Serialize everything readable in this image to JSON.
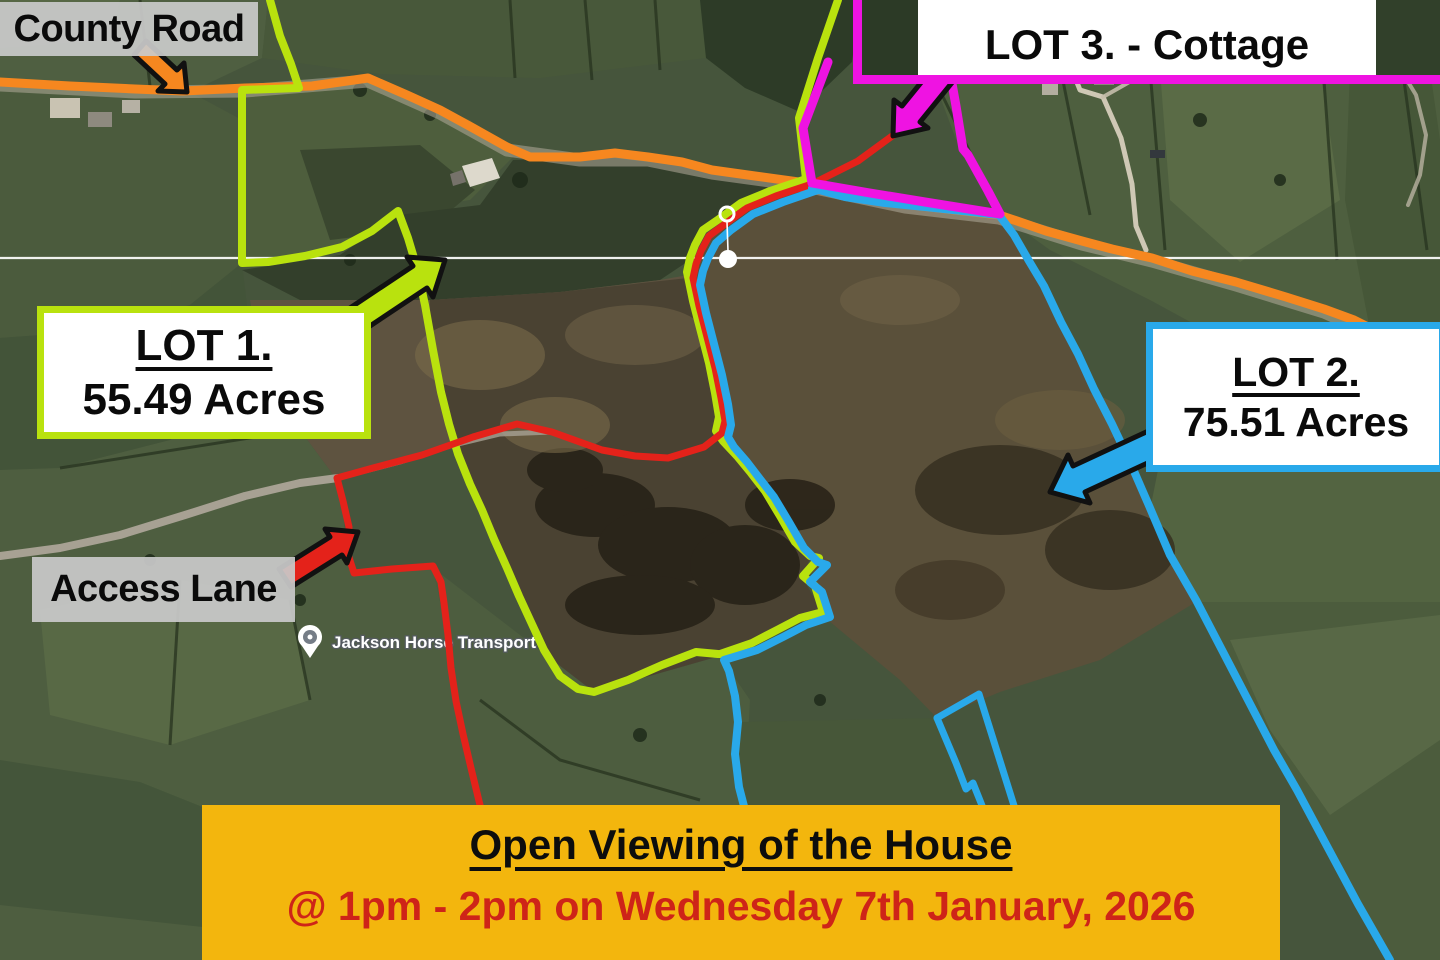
{
  "labels": {
    "county_road": "County Road",
    "access_lane": "Access Lane"
  },
  "lots": {
    "lot1": {
      "title": "LOT 1.",
      "area": "55.49 Acres"
    },
    "lot2": {
      "title": "LOT 2.",
      "area": "75.51 Acres"
    },
    "lot3": {
      "title": "LOT 3. - Cottage"
    }
  },
  "poi": {
    "name": "Jackson Horse Transport"
  },
  "banner": {
    "heading": "Open Viewing of the House",
    "detail": "@ 1pm - 2pm on Wednesday 7th January, 2026"
  },
  "colors": {
    "lot1_green": "#b9e20e",
    "lot2_blue": "#29a9ea",
    "lot3_magenta": "#ef13e2",
    "access_red": "#e4221a",
    "road_orange": "#f6871f",
    "banner_bg": "#f3b60d",
    "banner_detail_red": "#ce2418",
    "label_gray_bg": "#c9c9c9",
    "arrow_outline": "#111111"
  },
  "icons": {
    "map_pin": "map-pin-icon",
    "location_dot": "location-dot-icon",
    "crosshair_line": "horizontal-reference-line"
  }
}
